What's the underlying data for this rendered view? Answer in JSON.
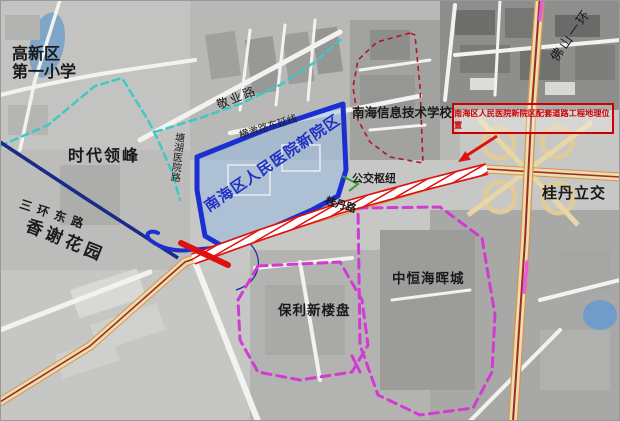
{
  "map": {
    "labels": {
      "school_primary_line1": "高新区",
      "school_primary_line2": "第一小学",
      "times_peak": "时代领峰",
      "ring3_east_road": "三环东路",
      "xiangxie_garden": "香谢花园",
      "hospital_site": "南海区人民医院新院区",
      "west_side_road": "塘湖医院路",
      "jingye_road": "敬业路",
      "hengjiao_extension": "横漖路东延线",
      "info_school": "南海信息技术学校",
      "bus_hub": "公交枢纽",
      "guidan_road": "桂丹路",
      "callout": "南海区人民医院新院区配套道路工程地理位置",
      "guidan_interchange": "桂丹立交",
      "foshan_ring": "佛山一环",
      "zhongheng_city": "中恒海晖城",
      "poly_new_estate": "保利新楼盘"
    },
    "colors": {
      "hospital_blue": "#1b2fd0",
      "project_red": "#dd1111",
      "callout_red": "#cc0000",
      "teal": "#3fc8c4",
      "magenta": "#d23bd2",
      "navy": "#1a2a8a",
      "school_dashed_red": "#b01825",
      "green": "#3a9d3a"
    }
  }
}
